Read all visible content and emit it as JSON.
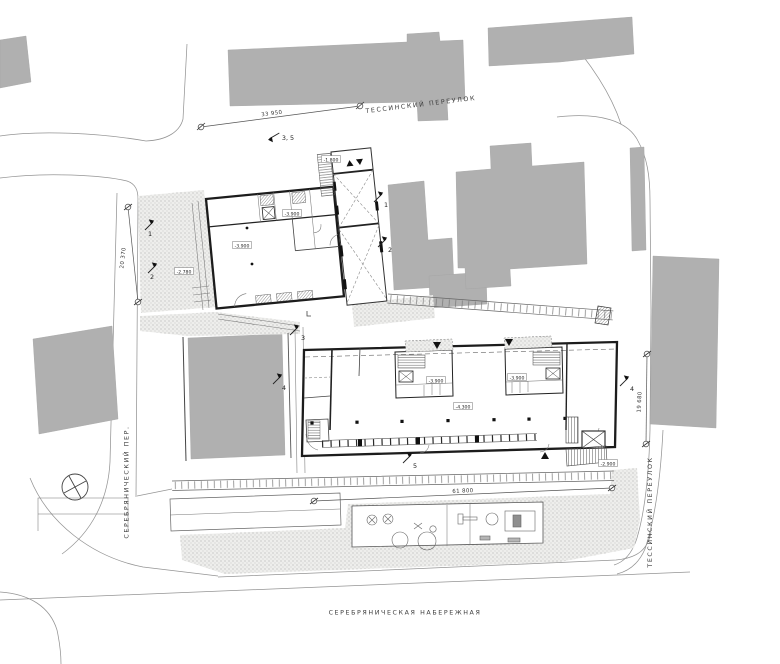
{
  "drawing": {
    "type": "architectural site plan"
  },
  "streets": {
    "top": "ТЕССИНСКИЙ ПЕРЕУЛОК",
    "right": "ТЕССИНСКИЙ ПЕРЕУЛОК",
    "left": "СЕРЕБРЯНИЧЕСКИЙ ПЕР.",
    "bottom": "СЕРЕБРЯНИЧЕСКАЯ НАБЕРЕЖНАЯ"
  },
  "dimensions": {
    "top": "33 950",
    "left": "20 370",
    "right": "19 680",
    "bottom": "61 800"
  },
  "levels": {
    "connector": "-1.800",
    "upper_north": "-3.900",
    "upper_main": "-3.900",
    "upper_terrace": "-2.780",
    "lower_core_left": "-3.900",
    "lower_core_right": "-3.900",
    "lower_main": "-4.300",
    "lower_ramp": "-2.900"
  },
  "markers": {
    "left_1": "1",
    "left_2": "2",
    "center_1": "1",
    "center_2": "2",
    "top_3_5": "3, 5",
    "court_3": "3",
    "court_4": "4",
    "right_4": "4",
    "bottom_5": "5"
  },
  "colors": {
    "existing_building_fill": "#b0b0b0",
    "wall_line": "#1c1c1c",
    "street_line": "#949494",
    "background": "#ffffff"
  }
}
